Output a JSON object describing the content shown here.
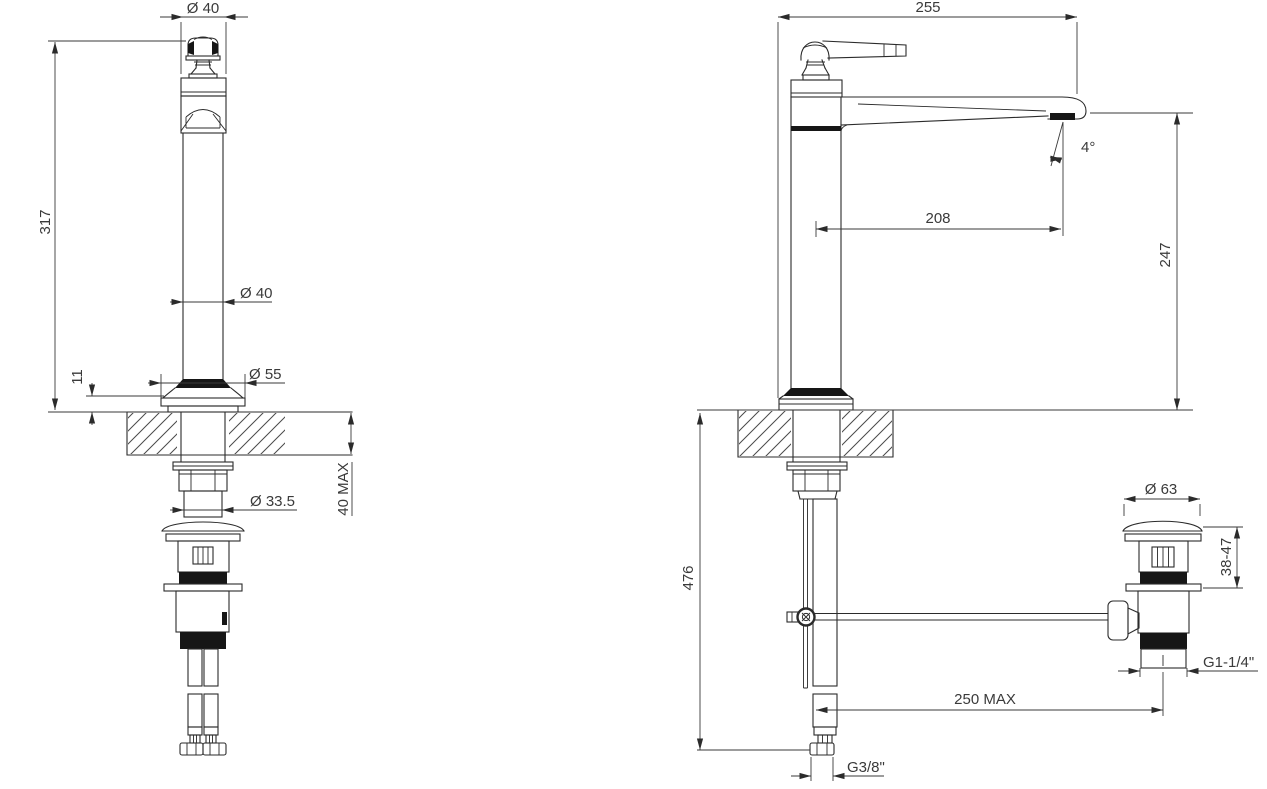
{
  "drawing": {
    "type": "faucet installation technical drawing, front and side views with pop-up waste and supply hoses",
    "colors": {
      "background": "#ffffff",
      "line": "#2b2b2b",
      "text": "#3a3a3a"
    },
    "front_view": {
      "top_diameter": "Ø 40",
      "overall_height": "317",
      "body_diameter": "Ø 40",
      "base_diameter": "Ø 55",
      "base_flange_height": "11",
      "shank_diameter": "Ø 33.5",
      "counter_thickness": "40 MAX"
    },
    "side_view": {
      "overall_depth": "255",
      "spout_tilt_angle": "4°",
      "spout_reach": "208",
      "spout_height": "247",
      "hose_drop": "476",
      "drain_cap_diameter": "Ø 63",
      "drain_height_range": "38-47",
      "drain_thread": "G1-1/4\"",
      "rod_reach_max": "250 MAX",
      "supply_thread": "G3/8\""
    }
  }
}
